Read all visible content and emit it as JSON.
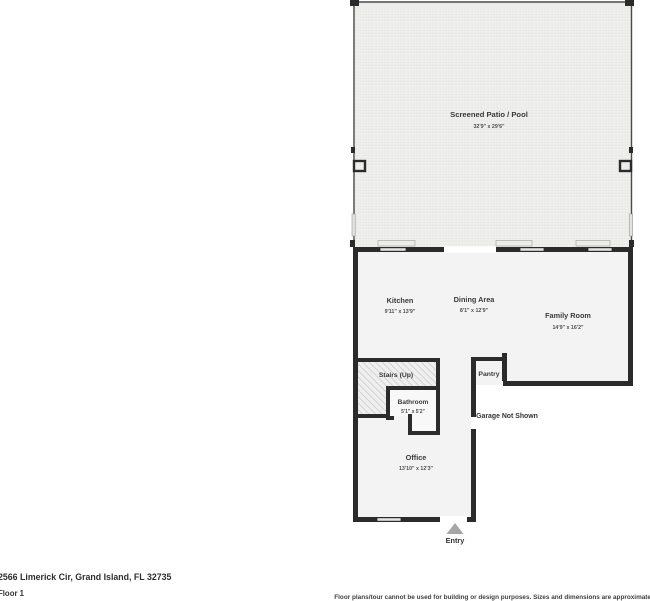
{
  "plan": {
    "patio": {
      "name": "Screened Patio / Pool",
      "dims": "32'9\" x 29'6\""
    },
    "kitchen": {
      "name": "Kitchen",
      "dims": "9'11\" x 13'9\""
    },
    "dining": {
      "name": "Dining Area",
      "dims": "8'1\" x 12'9\""
    },
    "family": {
      "name": "Family Room",
      "dims": "14'9\" x 16'2\""
    },
    "stairs": {
      "name": "Stairs (Up)"
    },
    "pantry": {
      "name": "Pantry"
    },
    "bathroom": {
      "name": "Bathroom",
      "dims": "5'1\" x 5'2\""
    },
    "office": {
      "name": "Office",
      "dims": "13'10\" x 12'3\""
    },
    "garage_note": "Garage Not Shown",
    "entry_label": "Entry",
    "colors": {
      "wall": "#2b2b2b",
      "room_fill": "#f3f3f3",
      "patio_fill": "#f2f2f0",
      "window_fill": "#e3e3e3",
      "hatch_line": "#c9c9c9",
      "entry_arrow": "#a6a6a6"
    }
  },
  "footer": {
    "address": "2566 Limerick Cir, Grand Island, FL 32735",
    "floor": "Floor 1",
    "disclaimer": "Floor plans/tour cannot be used for building or design purposes. Sizes and dimensions are approximate"
  }
}
